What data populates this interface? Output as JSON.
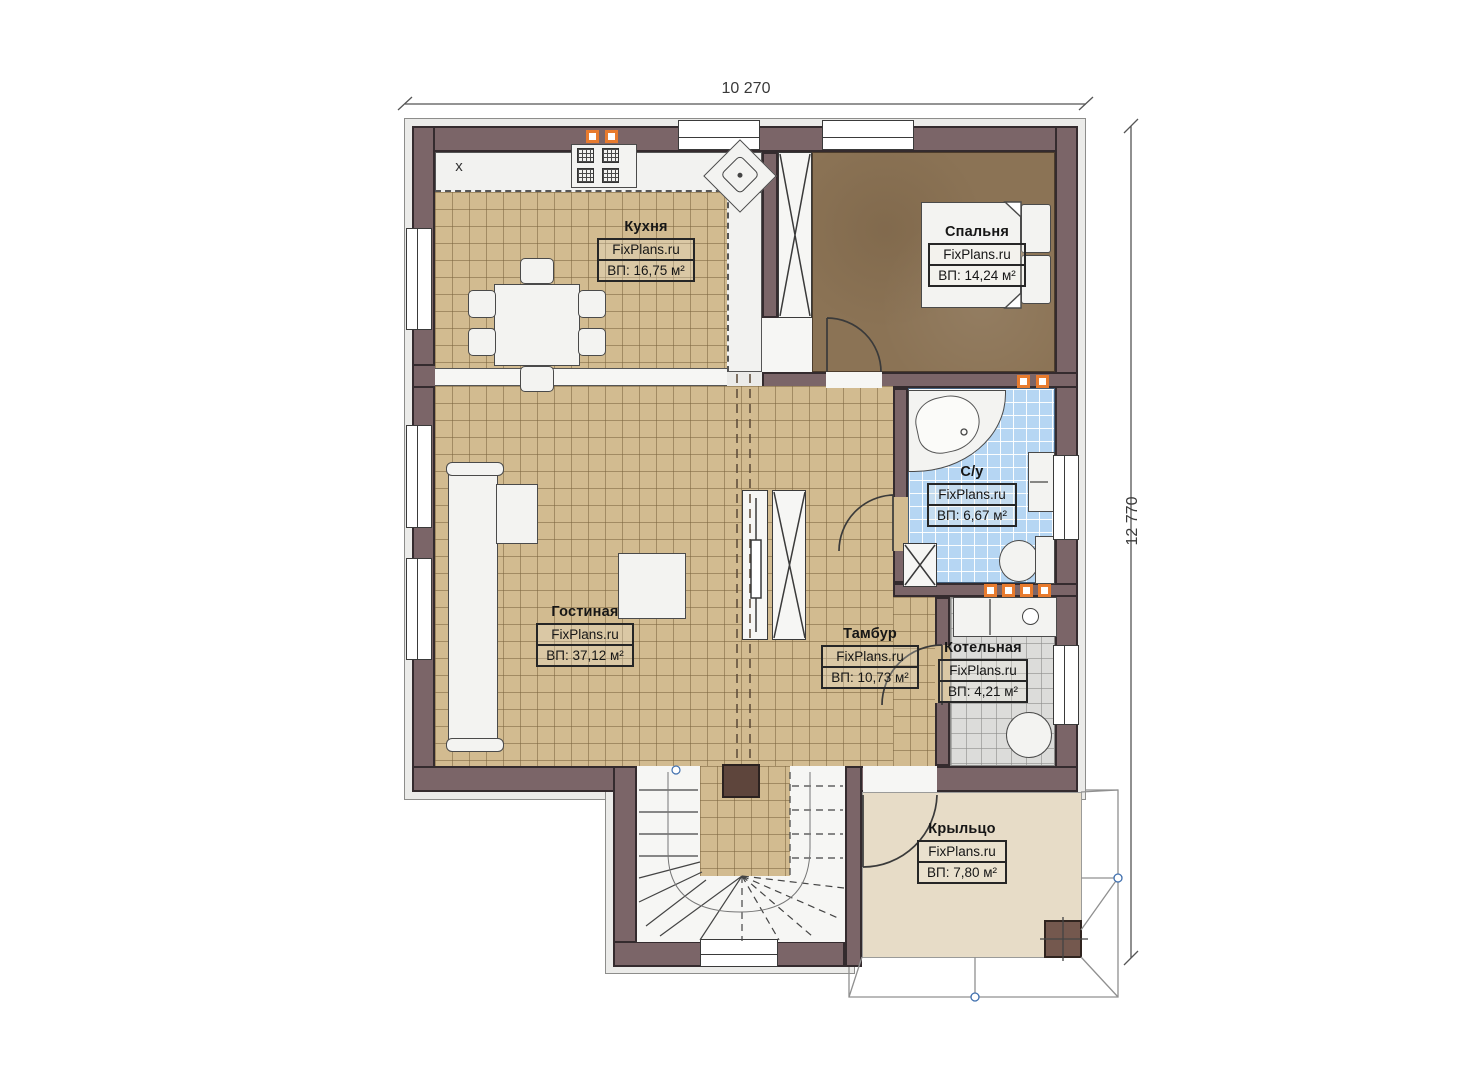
{
  "plan": {
    "dimension_top": "10 270",
    "dimension_right": "12 770",
    "marker_x": "x"
  },
  "rooms": [
    {
      "id": "kitchen",
      "name": "Кухня",
      "site": "FixPlans.ru",
      "area": "ВП: 16,75 м²"
    },
    {
      "id": "bedroom",
      "name": "Спальня",
      "site": "FixPlans.ru",
      "area": "ВП: 14,24 м²"
    },
    {
      "id": "bathroom",
      "name": "С/у",
      "site": "FixPlans.ru",
      "area": "ВП: 6,67 м²"
    },
    {
      "id": "living",
      "name": "Гостиная",
      "site": "FixPlans.ru",
      "area": "ВП: 37,12 м²"
    },
    {
      "id": "tambour",
      "name": "Тамбур",
      "site": "FixPlans.ru",
      "area": "ВП: 10,73 м²"
    },
    {
      "id": "boiler",
      "name": "Котельная",
      "site": "FixPlans.ru",
      "area": "ВП: 4,21 м²"
    },
    {
      "id": "porch",
      "name": "Крыльцо",
      "site": "FixPlans.ru",
      "area": "ВП: 7,80 м²"
    }
  ],
  "colors": {
    "wall": "#7b6568",
    "floor_tan": "#d2bb90",
    "floor_bedroom": "#8b7355",
    "floor_bath": "#b6d6f3",
    "floor_boiler": "#dcdcda",
    "floor_porch": "#e7dcc7",
    "indicator_orange": "#e87b2e",
    "node_blue": "#3f6fae"
  }
}
